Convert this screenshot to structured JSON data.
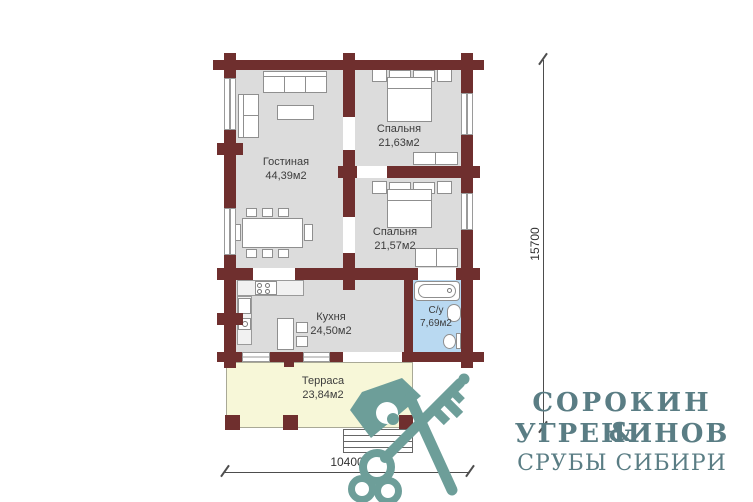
{
  "plan": {
    "rooms": [
      {
        "name": "Гостиная",
        "area": "44,39м2"
      },
      {
        "name": "Спальня",
        "area": "21,63м2"
      },
      {
        "name": "Спальня",
        "area": "21,57м2"
      },
      {
        "name": "Кухня",
        "area": "24,50м2"
      },
      {
        "name": "С/у",
        "area": "7,69м2"
      },
      {
        "name": "Терраса",
        "area": "23,84м2"
      }
    ],
    "dimensions": {
      "vertical": "15700",
      "horizontal": "10400"
    },
    "colors": {
      "wall": "#6f2f2e",
      "room_fill": "#dcdcdc",
      "bathroom_fill": "#b9d9f1",
      "terrace_fill": "#f7f7d8"
    }
  },
  "logo": {
    "line1": "СОРОКИН &",
    "line2": "УГРЕНИНОВ",
    "line3": "СРУБЫ СИБИРИ",
    "icon": "axe-and-key-crossed-icon",
    "text_color": "#5a7d84",
    "icon_color": "#6d9e99"
  }
}
